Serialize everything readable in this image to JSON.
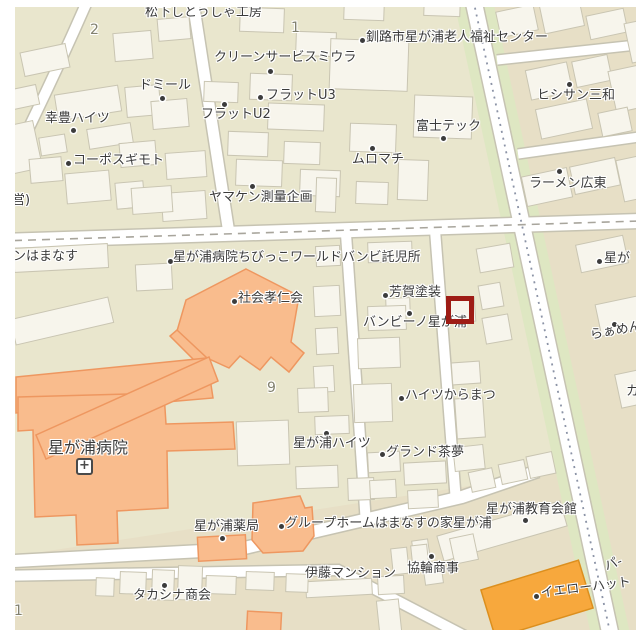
{
  "map": {
    "region_description": "Hoshigaura district street map",
    "palette": {
      "block_beige": "#e9e6cd",
      "block_tan": "#e7dfc6",
      "road_white": "#ffffff",
      "road_casing": "#c6c3b2",
      "green_strip": "#dee7c2",
      "building_fill": "#f7f5ec",
      "building_stroke": "#c9c5b2",
      "hospital_orange": "#f9bc8d",
      "hospital_stroke": "#ee9760",
      "store_orange": "#f7a83d",
      "store_stroke": "#dc8f1e",
      "cursor_red": "#9e1c15",
      "label_color": "#3b3b3b"
    },
    "cursor": {
      "x": 446,
      "y": 296,
      "size": 28
    },
    "hospital_icon": {
      "x": 76,
      "y": 458,
      "glyph": "+"
    },
    "labels": [
      {
        "text": "松下しとうしゃ工房",
        "x": 145,
        "y": 6
      },
      {
        "text": "クリーンサービスミウラ",
        "x": 214,
        "y": 51,
        "dot": {
          "x": 268,
          "y": 69
        }
      },
      {
        "text": "ドミール",
        "x": 139,
        "y": 79,
        "dot": {
          "x": 160,
          "y": 96
        }
      },
      {
        "text": "フラットU3",
        "x": 266,
        "y": 89,
        "dot": {
          "x": 258,
          "y": 95
        }
      },
      {
        "text": "フラットU2",
        "x": 201,
        "y": 108,
        "dot": {
          "x": 222,
          "y": 102
        }
      },
      {
        "text": "幸豊ハイツ",
        "x": 45,
        "y": 112,
        "dot": {
          "x": 71,
          "y": 128
        }
      },
      {
        "text": "コーポスギモト",
        "x": 73,
        "y": 154,
        "dot": {
          "x": 66,
          "y": 161
        }
      },
      {
        "text": "釧路市星が浦老人福祉センター",
        "x": 366,
        "y": 31,
        "dot": {
          "x": 360,
          "y": 38
        }
      },
      {
        "text": "富士テック",
        "x": 416,
        "y": 120,
        "dot": {
          "x": 441,
          "y": 136
        }
      },
      {
        "text": "ムロマチ",
        "x": 352,
        "y": 153,
        "dot": {
          "x": 370,
          "y": 146
        }
      },
      {
        "text": "ヒシサン三和",
        "x": 537,
        "y": 89,
        "dot": {
          "x": 567,
          "y": 82
        }
      },
      {
        "text": "ラーメン広東",
        "x": 529,
        "y": 177,
        "dot": {
          "x": 557,
          "y": 169
        }
      },
      {
        "text": "ヤマケン測量企画",
        "x": 209,
        "y": 191,
        "dot": {
          "x": 250,
          "y": 184
        }
      },
      {
        "text": "営)",
        "x": 12,
        "y": 194
      },
      {
        "text": "ンはまなす",
        "x": 13,
        "y": 250
      },
      {
        "text": "星が浦病院ちびっこワールドバンビ託児所",
        "x": 173,
        "y": 251,
        "dot": {
          "x": 168,
          "y": 259
        }
      },
      {
        "text": "社会孝仁会",
        "x": 238,
        "y": 292,
        "dot": {
          "x": 232,
          "y": 299
        }
      },
      {
        "text": "芳賀塗装",
        "x": 389,
        "y": 286,
        "dot": {
          "x": 383,
          "y": 293
        }
      },
      {
        "text": "バンビーノ星が浦",
        "x": 363,
        "y": 316,
        "dot": {
          "x": 407,
          "y": 311
        }
      },
      {
        "text": "ハイツからまつ",
        "x": 405,
        "y": 389,
        "dot": {
          "x": 399,
          "y": 396
        }
      },
      {
        "text": "星が浦病院",
        "x": 48,
        "y": 440,
        "size": 16
      },
      {
        "text": "星が",
        "x": 604,
        "y": 252,
        "dot": {
          "x": 597,
          "y": 259
        }
      },
      {
        "text": "らぁめん",
        "x": 589,
        "y": 329,
        "dot": {
          "x": 612,
          "y": 322
        },
        "rotate": -10
      },
      {
        "text": "カ",
        "x": 626,
        "y": 385
      },
      {
        "text": "星が浦ハイツ",
        "x": 293,
        "y": 437,
        "dot": {
          "x": 324,
          "y": 431
        }
      },
      {
        "text": "グランド茶夢",
        "x": 386,
        "y": 446,
        "dot": {
          "x": 380,
          "y": 452
        }
      },
      {
        "text": "星が浦薬局",
        "x": 194,
        "y": 520,
        "dot": {
          "x": 220,
          "y": 536
        }
      },
      {
        "text": "グループホームはまなすの家星が浦",
        "x": 285,
        "y": 517,
        "dot": {
          "x": 279,
          "y": 524
        }
      },
      {
        "text": "星が浦教育会館",
        "x": 486,
        "y": 503,
        "dot": {
          "x": 523,
          "y": 518
        }
      },
      {
        "text": "伊藤マンション",
        "x": 305,
        "y": 567
      },
      {
        "text": "協輪商事",
        "x": 407,
        "y": 562,
        "dot": {
          "x": 429,
          "y": 554
        }
      },
      {
        "text": "タカシナ商会",
        "x": 133,
        "y": 589,
        "dot": {
          "x": 162,
          "y": 583
        }
      },
      {
        "text": "イエローハット",
        "x": 540,
        "y": 587,
        "dot": {
          "x": 534,
          "y": 594
        },
        "rotate": -7
      },
      {
        "text": "パ-",
        "x": 603,
        "y": 561,
        "rotate": -20
      }
    ],
    "block_numbers": [
      {
        "text": "2",
        "x": 90,
        "y": 22
      },
      {
        "text": "1",
        "x": 291,
        "y": 20
      },
      {
        "text": "9",
        "x": 267,
        "y": 380
      },
      {
        "text": "1",
        "x": 14,
        "y": 603
      }
    ]
  }
}
